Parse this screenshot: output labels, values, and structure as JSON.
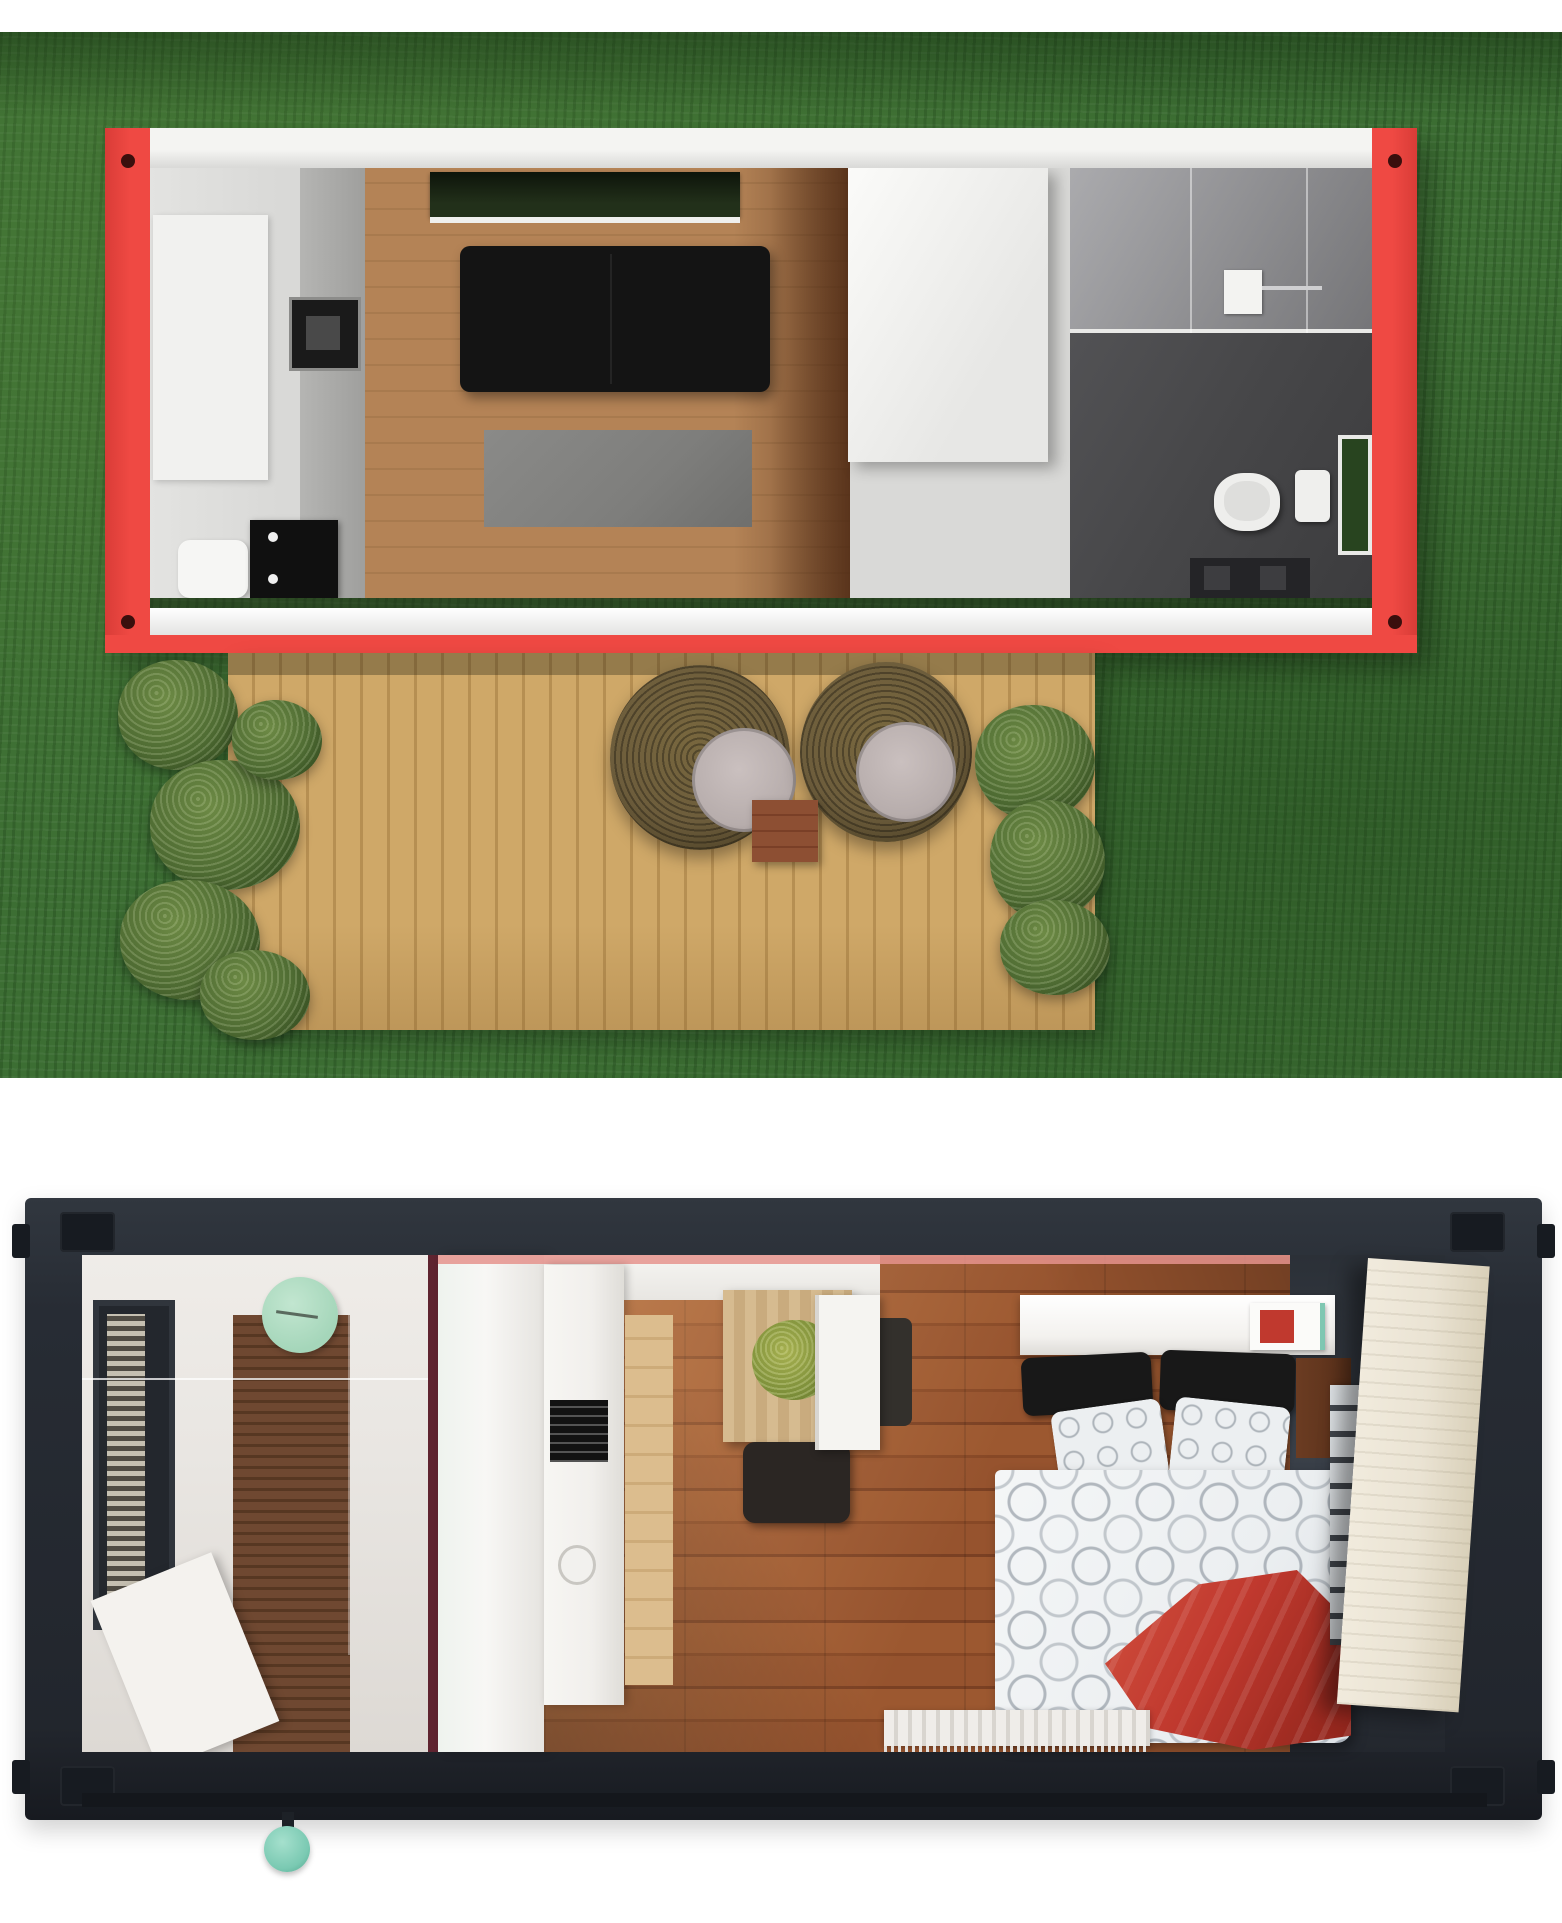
{
  "scene": {
    "title": "Two top-down 3D renders of shipping-container tiny homes",
    "views": [
      {
        "id": "red-container-on-lawn",
        "setting": "green grass lawn, aerial view",
        "container_frame": "bright red steel frame with white end walls and corner holes",
        "rooms": [
          {
            "name": "kitchen",
            "items": [
              "white cabinets",
              "gray counter run",
              "black built-in appliance",
              "white seat",
              "black dresser-desk"
            ]
          },
          {
            "name": "living-room",
            "items": [
              "dark roof window over sofa",
              "black two-seat sofa",
              "gray area rug",
              "light wood plank floor",
              "white storage partition"
            ]
          },
          {
            "name": "bathroom",
            "items": [
              "glass shower enclosure",
              "white shower unit with chrome arm",
              "white toilet",
              "white sink",
              "green garden window",
              "dark gray tile floor",
              "dark vanity"
            ]
          }
        ],
        "outdoor_deck": {
          "name": "timber deck",
          "items": [
            "two round wicker lounge chairs with gray cushions",
            "small square wood side table",
            "shrub planter strip on left",
            "shrub planter strip on right"
          ]
        }
      },
      {
        "id": "dark-container-in-studio",
        "setting": "plain white background",
        "container_frame": "charcoal steel frame with corner castings and teal valve knob",
        "rooms": [
          {
            "name": "bathroom",
            "items": [
              "black-framed side window with louvers",
              "mint green wall clock",
              "glass shower screen line",
              "walnut slat wall",
              "white bench slab"
            ]
          },
          {
            "name": "kitchen",
            "items": [
              "white counter column",
              "wood base cabinet front",
              "black cooktop",
              "round white sink",
              "white upper cabinet band"
            ]
          },
          {
            "name": "dining",
            "items": [
              "light wood dining table",
              "green potted plant",
              "dark chair below table",
              "dark chair beside table",
              "white fridge cabinet"
            ]
          },
          {
            "name": "bedroom",
            "items": [
              "double bed",
              "white headboard shelf",
              "red wall unit with teal edge",
              "two black pillows",
              "two circle-pattern pillows",
              "white circle-pattern duvet",
              "red throw blanket",
              "dark wood bedside panel",
              "white slatted runner",
              "striped fringe rug",
              "open cream door leaning at right"
            ]
          }
        ]
      }
    ]
  },
  "palette": {
    "page_bg": "#ffffff",
    "grass": "#3c6e33",
    "red_frame": "#ef4943",
    "red_frame_dark": "#d93c37",
    "wall_white": "#f4f4f2",
    "cabinet_gray": "#d9d9d7",
    "counter_gray": "#b5b5b3",
    "appliance_black": "#1a1a1a",
    "wood_light": "#b48356",
    "wood_light2": "#a87a4e",
    "sofa_black": "#141414",
    "skylight_green": "#22301a",
    "rug_gray": "#7e7e7c",
    "tile_dark": "#474749",
    "toilet_white": "#eeeeec",
    "window_green": "#28441f",
    "deck_wood": "#cfa868",
    "deck_wood_dark": "#b68f52",
    "plant_green": "#4f6c33",
    "plant_green_dark": "#324a1f",
    "wicker": "#6d5d3c",
    "wicker_dark": "#4e4227",
    "cushion_gray": "#b7adac",
    "table_wood": "#8d4f33",
    "frame_dark": "#272c34",
    "frame_darker": "#171b21",
    "bath_wall": "#e9e6e2",
    "bath_floor": "#6f4831",
    "bath_floor_dark": "#573722",
    "clock_mint": "#a5d6ba",
    "maroon_line": "#5f2430",
    "kitchen_counter_white": "#f1efec",
    "kitchen_wood": "#dcbd8e",
    "floor_red_wood": "#96532e",
    "floor_red_wood_dark": "#7a4023",
    "dining_wood": "#d6bb90",
    "chair_dark": "#2b2623",
    "bed_headboard": "#f3f1ee",
    "pillow_black": "#181818",
    "duvet_white": "#eceff1",
    "blanket_red": "#c0392e",
    "side_wood": "#6b3c22",
    "door_cream": "#eae3d3",
    "pink_line": "#e5938d",
    "knob_teal": "#7ac9b2",
    "rug_stripe": "#d8d5cf"
  }
}
